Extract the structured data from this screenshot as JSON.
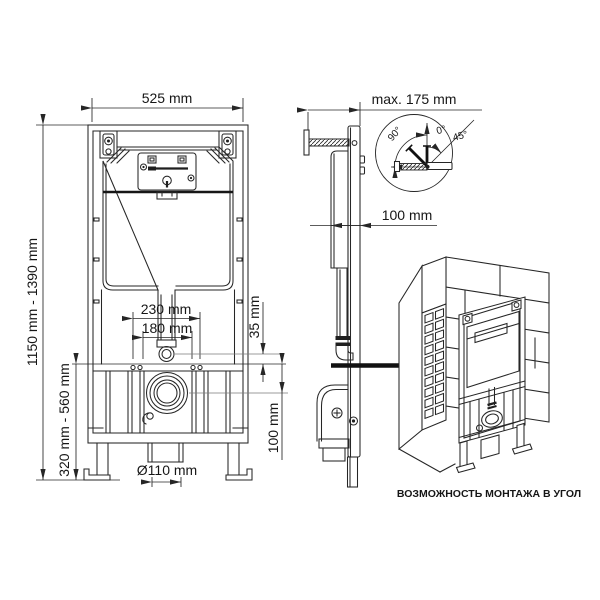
{
  "front_view": {
    "width": "525 mm",
    "height_range": "1150 mm - 1390 mm",
    "foot_height_range": "320 mm - 560 mm",
    "fixing_spacing_outer": "230 mm",
    "fixing_spacing_inner": "180 mm",
    "flush_pipe_offset": "35 mm",
    "drain_offset": "100 mm",
    "drain_diameter": "Ø110 mm"
  },
  "side_view": {
    "max_depth": "max. 175 mm",
    "frame_depth": "100 mm",
    "angle_detail": {
      "angle_full": "90°",
      "angle_zero": "0°",
      "angle_half": "45°"
    }
  },
  "corner_view": {
    "caption": "ВОЗМОЖНОСТЬ МОНТАЖА В УГОЛ"
  },
  "colors": {
    "line": "#262626",
    "reference_line": "#7a7a7a",
    "background": "#ffffff"
  }
}
